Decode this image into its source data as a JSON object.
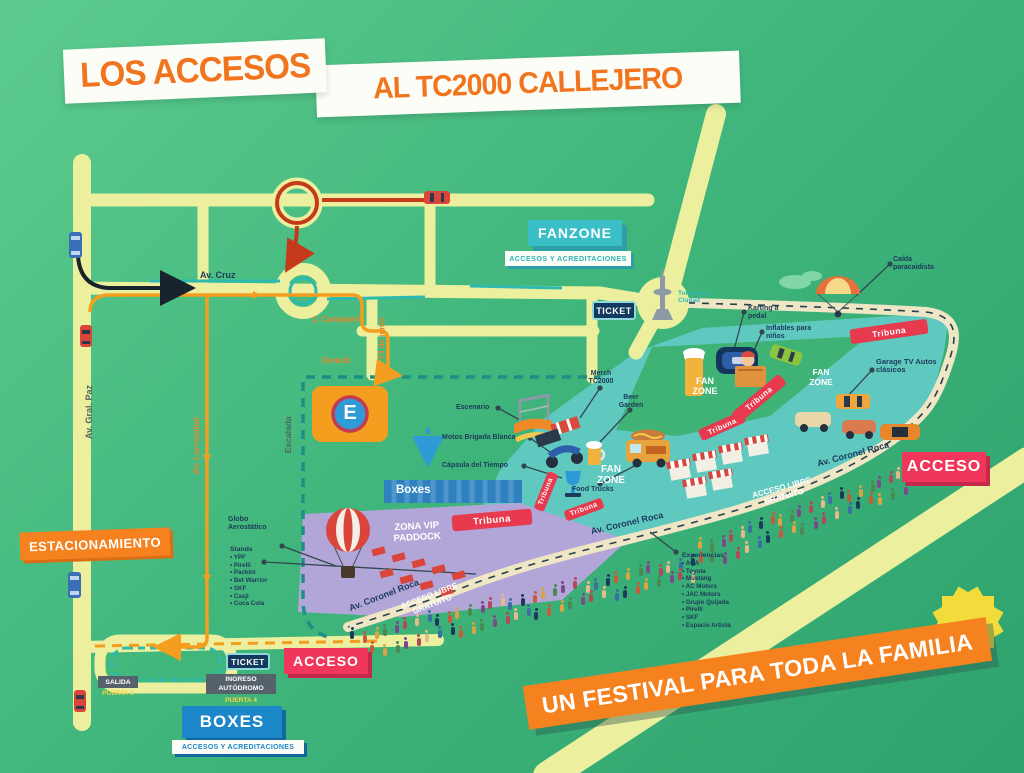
{
  "title": {
    "part1": "LOS ACCESOS",
    "part2": "AL TC2000 CALLEJERO"
  },
  "banners": {
    "fanzone_title": "FANZONE",
    "fanzone_subtitle": "ACCESOS Y ACREDITACIONES",
    "boxes_title": "BOXES",
    "boxes_subtitle": "ACCESOS Y ACREDITACIONES",
    "estacionamiento": "ESTACIONAMIENTO",
    "acceso_east": "ACCESO",
    "acceso_south": "ACCESO",
    "festival": "UN FESTIVAL PARA TODA LA FAMILIA"
  },
  "gates": {
    "ticket_north": "TICKET",
    "ticket_south": "TICKET",
    "salida_label": "SALIDA",
    "salida_gate": "PUERTA 3",
    "ingreso_label": "INGRESO AUTÓDROMO",
    "ingreso_gate": "PUERTA 4"
  },
  "streets": {
    "av_cruz": "Av. Cruz",
    "j_campbell": "J. Campbell",
    "junio23": "23 de junio",
    "demidi": "Demidi",
    "escalada": "Escalada",
    "av_gral_paz": "Av. Gral. Paz",
    "av_larrazabal": "Av. Larrazabal",
    "av_coronel_roca": "Av. Coronel Roca",
    "acceso_libre": "ACCESO LIBRE GRATUITO"
  },
  "zones": {
    "fan_zone": "FAN ZONE",
    "zona_vip_line1": "ZONA VIP",
    "zona_vip_line2": "PADDOCK",
    "tribuna": "Tribuna",
    "boxes_strip": "Boxes",
    "parking_letter": "E"
  },
  "poi": {
    "torre": "Torre de la Ciudad",
    "caida": "Caída paracaidista",
    "karting": "Karting a pedal",
    "inflables": "Inflables para niños",
    "garage_tv": "Garage TV Autos clásicos",
    "merch": "Merch TC2000",
    "beer_garden": "Beer Garden",
    "escenario": "Escenario",
    "motos": "Motos Brigada Blanca",
    "capsula": "Cápsula del Tiempo",
    "food_trucks": "Food Trucks",
    "globo": "Globo Aerostático"
  },
  "stands": {
    "title": "Stands",
    "items": [
      "YPF",
      "Pirelli",
      "Packini",
      "Bet Warrior",
      "SKF",
      "Casji",
      "Coca Cola"
    ]
  },
  "experiencias": {
    "title": "Experiencias",
    "items": [
      "ACA",
      "Toyota",
      "Mustang",
      "AC Motors",
      "JAC Motors",
      "Grupo Quijada",
      "Pirelli",
      "SKF",
      "Espacio Artista"
    ]
  },
  "colors": {
    "accent_orange": "#F5821F",
    "accent_red": "#F0365B",
    "accent_teal": "#3BBFC7",
    "accent_blue": "#1B86C8",
    "navy": "#1C3A5A",
    "road_yellow": "#ECEF9E",
    "site_teal": "#5FC9BF",
    "vip_purple": "#B2A6D8"
  }
}
